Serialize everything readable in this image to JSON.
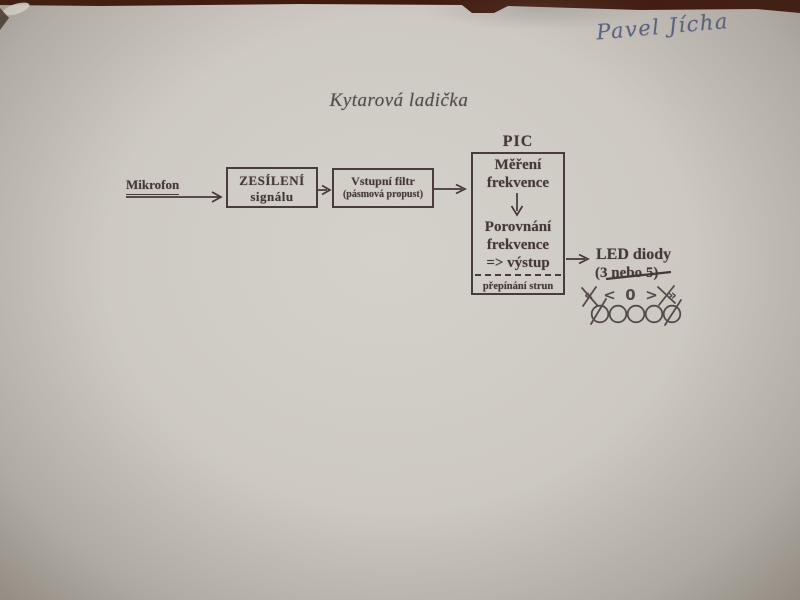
{
  "photo": {
    "signature": "Pavel Jícha",
    "title": "Kytarová ladička"
  },
  "diagram": {
    "mikrofon_label": "Mikrofon",
    "amp_block": {
      "line1": "ZESÍLENÍ",
      "line2": "signálu"
    },
    "filter_block": {
      "line1": "Vstupní filtr",
      "line2": "(pásmová propust)"
    },
    "pic_block": {
      "label": "PIC",
      "measure_line1": "Měření",
      "measure_line2": "frekvence",
      "compare_line1": "Porovnání",
      "compare_line2": "frekvence",
      "compare_line3": "=> výstup",
      "footer": "přepínání strun"
    },
    "led_block": {
      "line1": "LED diody",
      "line2": "(3 nebo 5)",
      "line2_struck_through": true
    },
    "led_indicator": {
      "symbols": [
        "«",
        "<",
        "0",
        ">",
        "»"
      ],
      "led_count": 5,
      "outer_elements_crossed_out": true
    }
  },
  "colors": {
    "paper": "#cdc9c2",
    "ink": "#45383a",
    "pen_blue": "#5d6688",
    "table_brown": "#421a0e",
    "sketch_ink": "#554a4e"
  }
}
